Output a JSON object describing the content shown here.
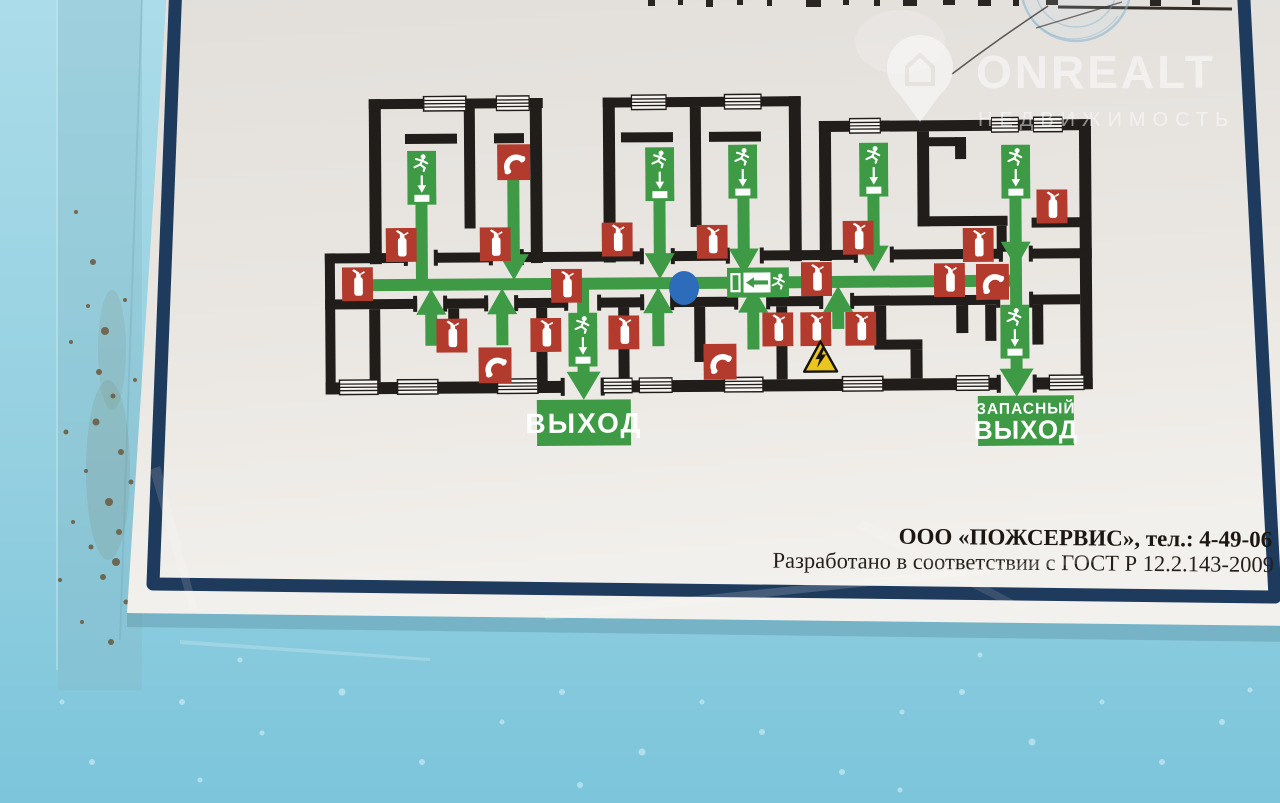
{
  "watermark": {
    "brand": "ONREALT",
    "tagline": "НЕДВИЖИМОСТЬ",
    "icon": "house-location-pin-icon"
  },
  "plan": {
    "exits": {
      "main_exit_label": "ВЫХОД",
      "emergency_exit_line1": "ЗАПАСНЫЙ",
      "emergency_exit_line2": "ВЫХОД"
    },
    "items": {
      "extinguishers": [
        [
          386,
          226
        ],
        [
          480,
          226
        ],
        [
          602,
          222
        ],
        [
          697,
          225
        ],
        [
          843,
          222
        ],
        [
          1037,
          192
        ],
        [
          963,
          230
        ],
        [
          342,
          265
        ],
        [
          551,
          268
        ],
        [
          801,
          263
        ],
        [
          934,
          265
        ],
        [
          436,
          317
        ],
        [
          530,
          317
        ],
        [
          608,
          315
        ],
        [
          762,
          313
        ],
        [
          800,
          313
        ],
        [
          845,
          313
        ]
      ],
      "phones": [
        [
          498,
          143
        ],
        [
          478,
          346
        ],
        [
          703,
          344
        ],
        [
          976,
          266
        ]
      ],
      "exit_signs": [
        [
          408,
          149
        ],
        [
          646,
          147
        ],
        [
          729,
          145
        ],
        [
          860,
          144
        ],
        [
          1002,
          147
        ],
        [
          568,
          312
        ],
        [
          1000,
          307
        ]
      ],
      "direction_sign": [
        727,
        268
      ],
      "hazard_sign": [
        802,
        341
      ],
      "you_are_here": [
        684,
        288
      ],
      "routes": [
        [
          352,
          283,
          1016,
          283
        ],
        [
          422,
          201,
          422,
          283
        ],
        [
          514,
          178,
          514,
          262
        ],
        [
          660,
          197,
          660,
          262
        ],
        [
          744,
          193,
          744,
          258
        ],
        [
          874,
          192,
          874,
          256
        ],
        [
          1016,
          195,
          1016,
          372
        ],
        [
          583,
          283,
          583,
          372
        ],
        [
          431,
          344,
          431,
          305
        ],
        [
          502,
          344,
          502,
          305
        ],
        [
          658,
          346,
          658,
          305
        ],
        [
          753,
          350,
          753,
          305
        ],
        [
          838,
          330,
          838,
          305
        ]
      ],
      "arrows_down": [
        [
          514,
          279
        ],
        [
          660,
          279
        ],
        [
          744,
          275
        ],
        [
          874,
          273
        ],
        [
          1016,
          270
        ]
      ],
      "arrows_up": [
        [
          431,
          287
        ],
        [
          502,
          287
        ],
        [
          658,
          287
        ],
        [
          753,
          287
        ],
        [
          838,
          287
        ]
      ],
      "exit_arrows": [
        [
          583,
          371
        ],
        [
          1016,
          371
        ]
      ]
    }
  },
  "footer": {
    "company": "ООО «ПОЖСЕРВИС», тел.: 4-49-06",
    "standard": "Разработано в соответствии с ГОСТ Р 12.2.143-2009"
  },
  "colors": {
    "route_green": "#3f9a46",
    "sign_red": "#b23b2d",
    "wall_black": "#201d1b",
    "frame_navy": "#1e3a5c",
    "marker_blue": "#2d6cbb",
    "hazard_yellow": "#eac51e",
    "wall_paint_blue": "#8ecbdd",
    "paper_white": "#ece9e5"
  },
  "icons": {
    "extinguisher": "fire-extinguisher-icon",
    "phone": "emergency-phone-icon",
    "exit_sign": "exit-route-sign-icon",
    "direction_sign": "exit-direction-sign-icon",
    "hazard": "electrical-hazard-icon",
    "marker": "you-are-here-marker",
    "window": "window-icon"
  }
}
